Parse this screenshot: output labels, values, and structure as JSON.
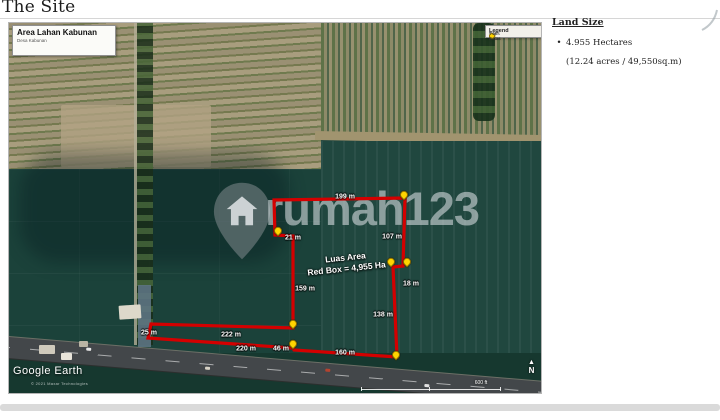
{
  "page": {
    "title": "The Site"
  },
  "land_size_panel": {
    "heading": "Land Size",
    "bullet_symbol": "•",
    "bullet": "4.955 Hectares",
    "detail": "(12.24 acres / 49,550sq.m)"
  },
  "map": {
    "info_box": {
      "title": "Area Lahan Kabunan",
      "subtitle": "Desa Kabunan"
    },
    "legend": {
      "title": "Legend",
      "items": [
        {
          "icon": "boundary-line-icon",
          "label": "Garis Batas"
        },
        {
          "icon": "boundary-point-icon",
          "label": "Titik Batas"
        }
      ]
    },
    "area_label": {
      "line1": "Luas Area",
      "line2": "Red Box = 4,955 Ha"
    },
    "watermark_text": "rumah123",
    "google_earth_label": "Google Earth",
    "attribution": "© 2021 Maxar Technologies",
    "scale_label": "600 ft",
    "north_label": "N",
    "north_arrow_glyph": "▲",
    "measurements": [
      {
        "label": "199 m",
        "x": 336,
        "y": 174
      },
      {
        "label": "21 m",
        "x": 284,
        "y": 215
      },
      {
        "label": "107 m",
        "x": 383,
        "y": 214
      },
      {
        "label": "159 m",
        "x": 296,
        "y": 266
      },
      {
        "label": "18 m",
        "x": 402,
        "y": 261
      },
      {
        "label": "138 m",
        "x": 374,
        "y": 292
      },
      {
        "label": "222 m",
        "x": 222,
        "y": 312
      },
      {
        "label": "25 m",
        "x": 140,
        "y": 310
      },
      {
        "label": "220 m",
        "x": 237,
        "y": 326
      },
      {
        "label": "46 m",
        "x": 272,
        "y": 326
      },
      {
        "label": "160 m",
        "x": 336,
        "y": 330
      }
    ],
    "boundary_points": "265,177 396,175 394,243 384,244 388,334 285,327 284,325 139,315 142,301 284,305 284,213 266,212",
    "boundary_pins": [
      {
        "x": 395,
        "y": 175
      },
      {
        "x": 269,
        "y": 211
      },
      {
        "x": 382,
        "y": 242
      },
      {
        "x": 398,
        "y": 242
      },
      {
        "x": 284,
        "y": 304
      },
      {
        "x": 284,
        "y": 324
      },
      {
        "x": 387,
        "y": 335
      }
    ]
  },
  "colors": {
    "boundary_red": "#d40000",
    "pin_yellow": "#ffd400"
  }
}
